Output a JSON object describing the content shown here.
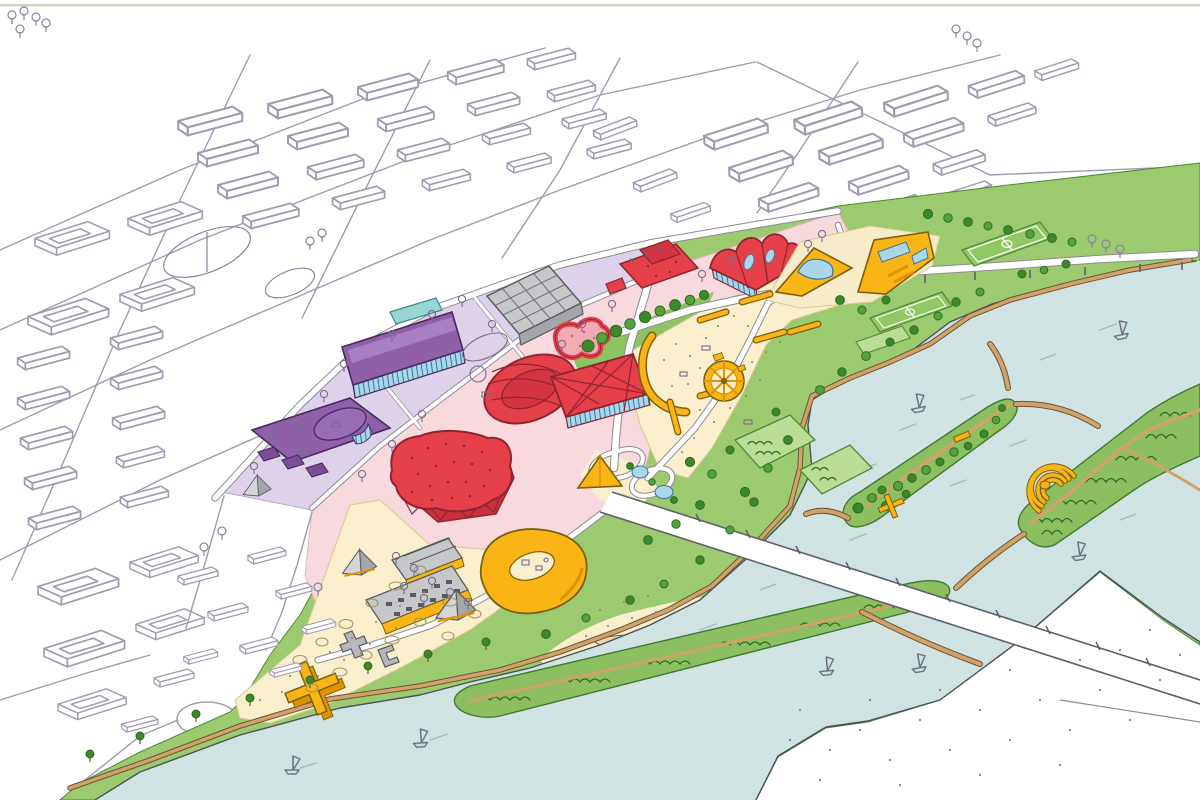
{
  "image": {
    "kind": "hand-drawn aerial masterplan illustration",
    "view": "axonometric bird's-eye sketch, no text or UI elements",
    "width_px": 1200,
    "height_px": 800
  },
  "palette": {
    "paper": "#ffffff",
    "paper_edge": "#d8d3c4",
    "sketch_line": "#a29ab0",
    "lavender_zone": "#ded2ea",
    "purple_building": "#8f5fa8",
    "purple_dark": "#6c4187",
    "glazing_blue": "#aad6ea",
    "teal_pool": "#97d7d1",
    "pink_zone": "#f7d9de",
    "pink_pool": "#f2aab5",
    "red_building": "#e5404a",
    "red_side": "#c9303c",
    "red_outline": "#8e2630",
    "gray_building": "#c6c7c9",
    "gray_side": "#a4a6aa",
    "yellow_building": "#f9b515",
    "yellow_side": "#e09200",
    "cream_zone": "#f9efcd",
    "sand_spit": "#e8d9a8",
    "park_green": "#9ccb6f",
    "plot_green": "#b9dd97",
    "pitch_green": "#90c863",
    "island_green": "#8cbf60",
    "tree_green": "#3c882b",
    "tree_dark": "#2f6d23",
    "river_blue": "#cfe3e3",
    "path_tan": "#d2a368",
    "road_white": "#ffffff",
    "road_edge": "#8b8b93",
    "bridge_edge": "#5d5f6a",
    "boat_line": "#6f7480",
    "stipple": "#8a855e"
  },
  "scene": {
    "context_city": {
      "style": "uncolored line sketch of existing city blocks",
      "features": [
        "housing slab rows",
        "courtyard blocks",
        "sports field outline",
        "roundabout",
        "street grid",
        "small sketched trees"
      ]
    },
    "masterplan_zones": [
      {
        "name": "lavender-cultural-quarter",
        "color_key": "lavender_zone"
      },
      {
        "name": "pink-arena-quarter",
        "color_key": "pink_zone"
      },
      {
        "name": "cream-event-park",
        "color_key": "cream_zone"
      },
      {
        "name": "green-riverside-park",
        "color_key": "park_green"
      },
      {
        "name": "cream-beach-waterfront",
        "color_key": "cream_zone"
      }
    ],
    "buildings": [
      {
        "name": "purple-hall-north",
        "color_key": "purple_building"
      },
      {
        "name": "purple-hall-south",
        "color_key": "purple_building"
      },
      {
        "name": "gray-gridshell-pavilion",
        "color_key": "gray_building"
      },
      {
        "name": "red-oval-arena",
        "color_key": "red_building"
      },
      {
        "name": "red-lattice-hall",
        "color_key": "red_building"
      },
      {
        "name": "red-amoeba-pool",
        "color_key": "pink_pool"
      },
      {
        "name": "red-convention-blob",
        "color_key": "red_building"
      },
      {
        "name": "red-workshop-cluster",
        "color_key": "red_building"
      },
      {
        "name": "red-tent-hall",
        "color_key": "red_building"
      },
      {
        "name": "yellow-pool-wedge-west",
        "color_key": "yellow_building"
      },
      {
        "name": "yellow-pool-wedge-east",
        "color_key": "yellow_building"
      },
      {
        "name": "yellow-triangle-pavilion",
        "color_key": "yellow_building"
      },
      {
        "name": "yellow-courtyard-pavilion",
        "color_key": "yellow_building"
      },
      {
        "name": "yellow-cross-pavilion",
        "color_key": "yellow_building"
      },
      {
        "name": "gray-terrace-buildings",
        "count": 2,
        "color_key": "gray_building"
      },
      {
        "name": "gray-pyramids",
        "count": 3,
        "color_key": "gray_building"
      },
      {
        "name": "gray-letter-sculptures",
        "count": 2,
        "color_key": "gray_building"
      }
    ],
    "park_features": [
      "yellow-ferris-wheel-plaza",
      "yellow-skate-ramps",
      "hedged-garden-plots",
      "football-pitch x2",
      "tree-rows"
    ],
    "river": {
      "islands": [
        {
          "name": "lawn-island",
          "features": [
            "scattered trees",
            "yellow X marker",
            "shore path"
          ]
        },
        {
          "name": "forest-island",
          "features": [
            "dense scribbled woods",
            "yellow-amphitheatre",
            "path junction"
          ]
        },
        {
          "name": "long-wooded-island",
          "features": [
            "spine path",
            "dense trees"
          ]
        }
      ],
      "crossings": [
        "main-road-bridge-with-piers",
        "elevated-riverside-viaduct",
        "arched-footbridges x6"
      ],
      "sailboats": 7
    }
  }
}
